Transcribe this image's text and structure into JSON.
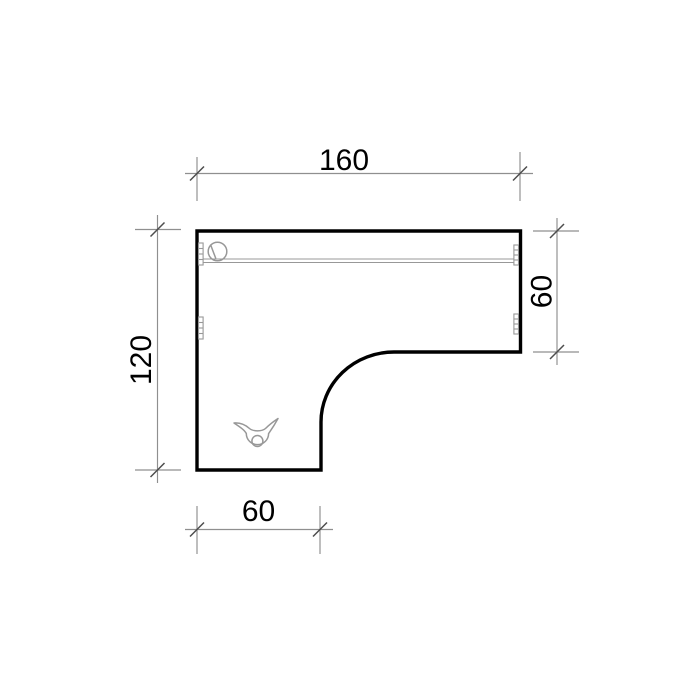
{
  "drawing": {
    "kind": "furniture plan, top view, L-shaped desk",
    "dimensions": {
      "top": {
        "label": "160"
      },
      "left": {
        "label": "120"
      },
      "right": {
        "label": "60"
      },
      "bottom": {
        "label": "60"
      }
    }
  },
  "icons": {
    "grommet": "cable-grommet-icon",
    "outlet": "cable-outlet-icon",
    "hinge": "hinge-mark-icon"
  },
  "colors": {
    "background": "#ffffff",
    "outline": "#000000",
    "detail": "#989898",
    "dimension": "#8f8f8f",
    "tick": "#4d4d4d",
    "text": "#000000"
  }
}
